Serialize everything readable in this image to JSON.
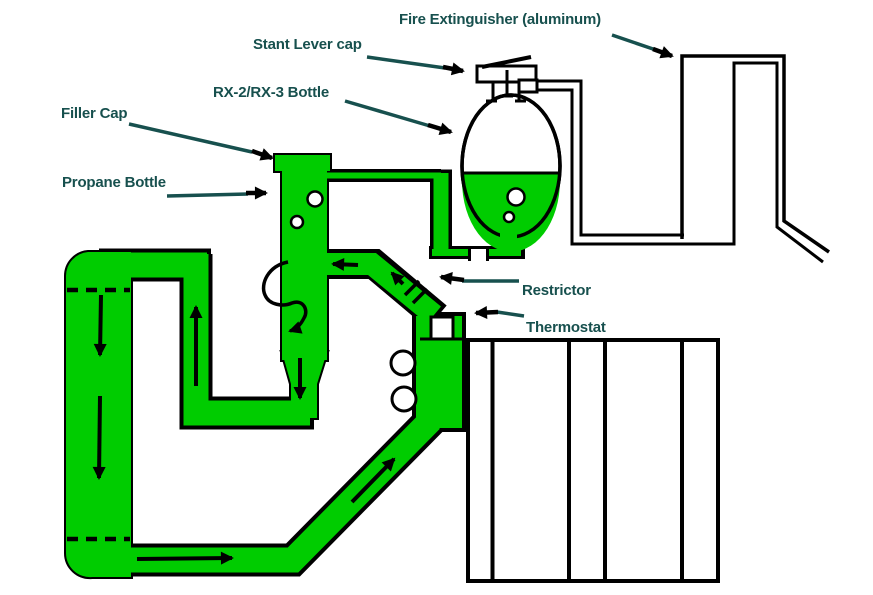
{
  "diagram": {
    "labels": {
      "fire_extinguisher": "Fire Extinguisher (aluminum)",
      "stant_lever_cap": "Stant Lever cap",
      "rx_bottle": "RX-2/RX-3 Bottle",
      "filler_cap": "Filler Cap",
      "propane_bottle": "Propane Bottle",
      "restrictor": "Restrictor",
      "thermostat": "Thermostat"
    },
    "colors": {
      "pipe_green": "#00CC00",
      "label_teal": "#17504E",
      "line_black": "#000000"
    }
  }
}
